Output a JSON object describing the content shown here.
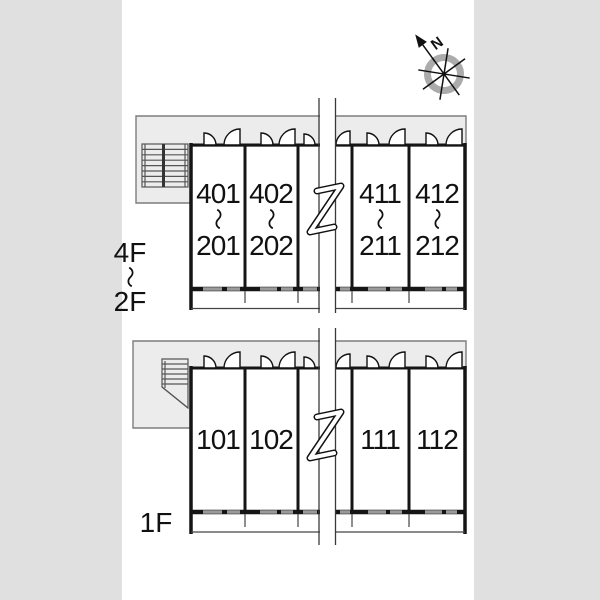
{
  "title": "apartment-building-floor-plan",
  "colors": {
    "backdrop": "#e0e0e0",
    "paper": "#ffffff",
    "corridor": "#ececec",
    "corridor_border": "#7d7d7d",
    "wall": "#151515",
    "window": "#9a9a9a",
    "thin_line": "#444444",
    "stair_line": "#555555",
    "compass_ring": "#ababab",
    "ink": "#111111"
  },
  "compass": {
    "north_label": "N"
  },
  "upper_section": {
    "floor_label": {
      "top": "4F",
      "separator": "～",
      "bottom": "2F"
    },
    "units": [
      {
        "top": "401",
        "separator": "～",
        "bottom": "201"
      },
      {
        "top": "402",
        "separator": "～",
        "bottom": "202"
      },
      {
        "top": "411",
        "separator": "～",
        "bottom": "211"
      },
      {
        "top": "412",
        "separator": "～",
        "bottom": "212"
      }
    ]
  },
  "lower_section": {
    "floor_label": "1F",
    "units": [
      {
        "number": "101"
      },
      {
        "number": "102"
      },
      {
        "number": "111"
      },
      {
        "number": "112"
      }
    ]
  },
  "icons": {
    "compass": "compass-rose-with-north-arrow",
    "stairs": "staircase",
    "door": "door-swing-arc",
    "break": "omission-break-zigzag"
  }
}
